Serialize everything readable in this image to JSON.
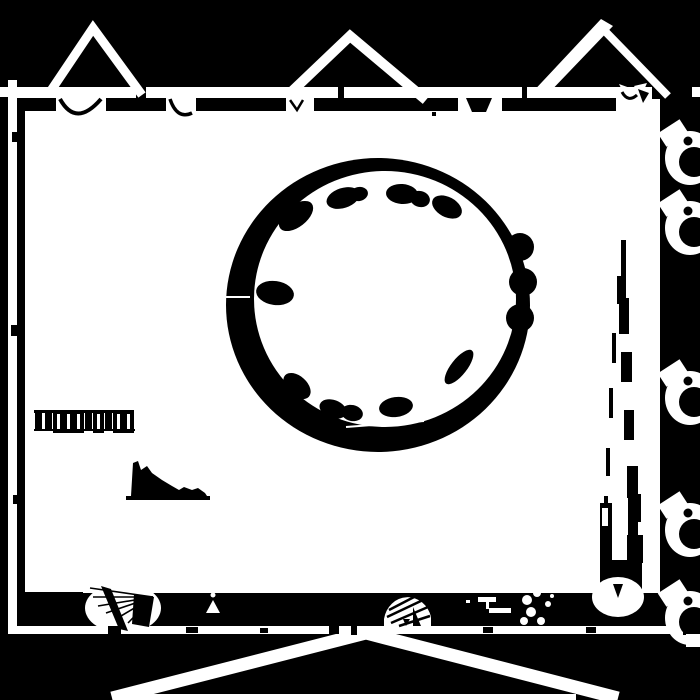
{
  "palette": {
    "background": "#000000",
    "ink": "#ffffff"
  },
  "scene": {
    "description": "High-contrast black-and-white abstract artwork resembling a thresholded architectural floor plan: white room on black field, framed by white bands, three triangle roof marks on top, wide chevron below, large black ring (round table) with blob chairs inside, clamp-like fixtures along the right edge",
    "visible_text": "",
    "counts": {
      "top_triangles": 3,
      "chairs": 12,
      "table_knobs": 3,
      "right_clamps": 5,
      "window_bars": 10
    }
  },
  "shapes": {
    "chairs": [
      [
        296,
        216,
        20,
        11,
        -38
      ],
      [
        343,
        198,
        17,
        10,
        -18
      ],
      [
        359,
        194,
        9,
        7,
        -12
      ],
      [
        402,
        194,
        16,
        10,
        4
      ],
      [
        420,
        199,
        10,
        8,
        14
      ],
      [
        447,
        207,
        16,
        10,
        28
      ],
      [
        275,
        293,
        19,
        12,
        8
      ],
      [
        297,
        386,
        16,
        10,
        42
      ],
      [
        333,
        409,
        14,
        9,
        20
      ],
      [
        352,
        413,
        11,
        8,
        12
      ],
      [
        396,
        407,
        17,
        10,
        -8
      ],
      [
        459,
        367,
        21,
        8,
        -52
      ]
    ],
    "knobs": [
      [
        520,
        247,
        14
      ],
      [
        523,
        282,
        14
      ],
      [
        520,
        318,
        14
      ]
    ],
    "ring_slashes": [
      [
        224,
        220,
        258,
        211
      ],
      [
        222,
        297,
        250,
        297
      ],
      [
        346,
        427,
        424,
        421
      ]
    ],
    "clamp_centers_y": [
      158,
      228,
      398,
      530,
      618
    ],
    "window_bars": {
      "x": 35,
      "y": 412,
      "width": 7,
      "height": 19,
      "gap": 3,
      "pattern": [
        "solid",
        "solid",
        "outline",
        "outline",
        "outline",
        "solid",
        "outline",
        "solid",
        "outline",
        "outline"
      ]
    },
    "stepped_bars": [
      [
        621,
        240,
        5,
        42
      ],
      [
        617,
        276,
        9,
        28
      ],
      [
        619,
        298,
        10,
        36
      ],
      [
        621,
        352,
        11,
        30
      ],
      [
        624,
        410,
        10,
        30
      ],
      [
        627,
        466,
        11,
        32
      ],
      [
        631,
        494,
        10,
        28
      ],
      [
        600,
        503,
        12,
        74
      ],
      [
        628,
        498,
        10,
        64
      ],
      [
        627,
        535,
        16,
        28
      ],
      [
        600,
        560,
        42,
        33
      ]
    ],
    "stepped_dashes": [
      [
        612,
        333,
        4,
        30
      ],
      [
        609,
        388,
        4,
        30
      ],
      [
        606,
        448,
        4,
        28
      ],
      [
        604,
        496,
        4,
        24
      ]
    ],
    "fan_lines": {
      "origin": [
        153,
        597
      ],
      "targets": [
        [
          90,
          588
        ],
        [
          93,
          597
        ],
        [
          98,
          606
        ],
        [
          106,
          613
        ],
        [
          116,
          619
        ],
        [
          128,
          623
        ]
      ]
    },
    "dash_marks": [
      [
        478,
        597,
        18,
        5
      ],
      [
        489,
        608,
        22,
        5
      ],
      [
        486,
        602,
        3,
        7
      ],
      [
        466,
        600,
        4,
        3
      ]
    ],
    "dots": [
      [
        527,
        600,
        5
      ],
      [
        537,
        593,
        4
      ],
      [
        531,
        612,
        5
      ],
      [
        541,
        621,
        4
      ],
      [
        548,
        604,
        3
      ],
      [
        524,
        621,
        4
      ],
      [
        545,
        589,
        2.5
      ],
      [
        552,
        596,
        2
      ]
    ],
    "band_ticks": [
      [
        108,
        626,
        13,
        8
      ],
      [
        186,
        627,
        12,
        6
      ],
      [
        260,
        628,
        8,
        5
      ],
      [
        329,
        626,
        10,
        8
      ],
      [
        351,
        626,
        6,
        9
      ],
      [
        483,
        627,
        10,
        6
      ],
      [
        586,
        627,
        10,
        6
      ],
      [
        683,
        626,
        15,
        9
      ]
    ],
    "strip_ticks": [
      [
        12,
        132,
        7,
        10
      ],
      [
        11,
        325,
        8,
        11
      ],
      [
        13,
        495,
        6,
        9
      ]
    ]
  }
}
